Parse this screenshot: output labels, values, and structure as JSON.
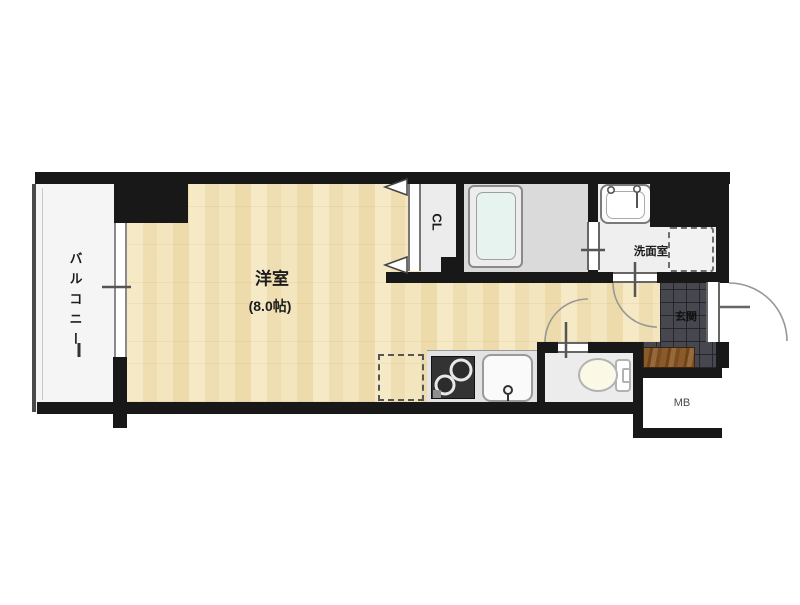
{
  "floor_plan": {
    "rooms": {
      "balcony": {
        "label": "バルコニー"
      },
      "main_room": {
        "label": "洋室",
        "size_label": "(8.0帖)"
      },
      "closet": {
        "label": "CL"
      },
      "washroom": {
        "label": "洗面室"
      },
      "entrance": {
        "label": "玄関"
      },
      "meter_box": {
        "label": "MB"
      }
    },
    "fixtures": [
      "bathtub",
      "washbasin",
      "washing-machine-pan",
      "toilet",
      "stove",
      "kitchen-sink",
      "refrigerator-space",
      "entrance-step"
    ],
    "colors": {
      "wall": "#181818",
      "arc": "#979797",
      "balcony": "#f5f5f5",
      "bath-floor": "#dadada",
      "wash-floor": "#efefef",
      "closet-floor": "#ececec",
      "toilet-floor": "#ececec",
      "counter": "#e3e3e3",
      "tub-inner": "#e7f3ee",
      "tile": "#47474f",
      "tile-line": "#26262c",
      "step": "#8a5a2b",
      "label": "#1c1c1c",
      "mb-label": "#4a4a4a",
      "stove": "#333333"
    }
  }
}
